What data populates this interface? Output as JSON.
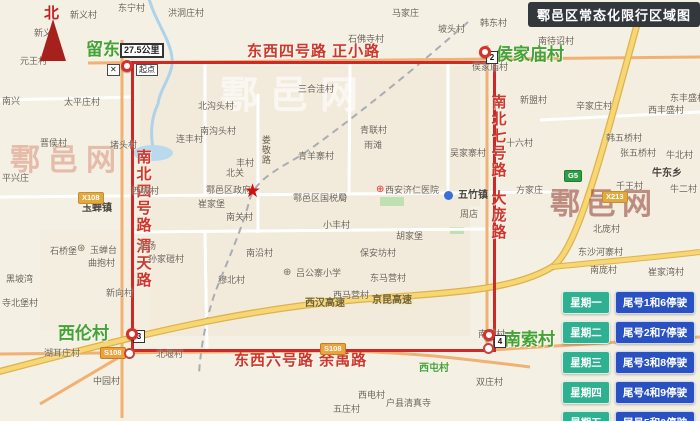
{
  "title": "鄠邑区常态化限行区域图",
  "compass_label": "北",
  "watermark_text": "鄠邑网",
  "colors": {
    "zone_border": "#cd2a27",
    "road_label_red": "#ce372c",
    "village_green": "#44a335",
    "legend_day_green": "#2fb090",
    "legend_rule_blue": "#2a51c2",
    "banner_bg": "#33383d"
  },
  "legend_rows": [
    {
      "day": "星期一",
      "rule": "尾号1和6停驶"
    },
    {
      "day": "星期二",
      "rule": "尾号2和7停驶"
    },
    {
      "day": "星期三",
      "rule": "尾号3和8停驶"
    },
    {
      "day": "星期四",
      "rule": "尾号4和9停驶"
    },
    {
      "day": "星期五",
      "rule": "尾号5和0停驶"
    }
  ],
  "map_labels": [
    {
      "t": "东西四号路  正小路",
      "x": 247,
      "y": 44,
      "c": "rh",
      "n": "top-boundary-road-label"
    },
    {
      "t": "东西六号路  余禹路",
      "x": 234,
      "y": 353,
      "c": "rh",
      "n": "bottom-boundary-road-label"
    },
    {
      "t": "南北四号路",
      "x": 134,
      "y": 149,
      "c": "rv",
      "n": "left-boundary-road-label"
    },
    {
      "t": "渭天路",
      "x": 134,
      "y": 238,
      "c": "rv",
      "n": "left-boundary-road-label-2"
    },
    {
      "t": "南北七号路",
      "x": 489,
      "y": 94,
      "c": "rv",
      "n": "right-boundary-road-label"
    },
    {
      "t": "大庞路",
      "x": 489,
      "y": 190,
      "c": "rv",
      "n": "right-boundary-road-label-2"
    },
    {
      "t": "留东",
      "x": 86,
      "y": 41,
      "c": "grl",
      "n": "village-label-liudong"
    },
    {
      "t": "侯家庙村",
      "x": 496,
      "y": 46,
      "c": "grl",
      "n": "village-label-houjiamiao"
    },
    {
      "t": "西伦村",
      "x": 58,
      "y": 325,
      "c": "grl",
      "n": "village-label-xilun"
    },
    {
      "t": "南索村",
      "x": 504,
      "y": 331,
      "c": "grl",
      "n": "village-label-nansuo"
    },
    {
      "t": "西屯村",
      "x": 419,
      "y": 363,
      "c": "grs"
    },
    {
      "t": "鄠邑网",
      "x": 220,
      "y": 76,
      "c": "wm1",
      "n": "watermark"
    },
    {
      "t": "鄠邑网",
      "x": 10,
      "y": 144,
      "c": "wm2",
      "n": "watermark"
    },
    {
      "t": "鄠邑网",
      "x": 550,
      "y": 188,
      "c": "wm3",
      "n": "watermark"
    },
    {
      "t": "西汉高速",
      "x": 305,
      "y": 298,
      "c": "hw",
      "n": "expressway-label"
    },
    {
      "t": "京昆高速",
      "x": 372,
      "y": 295,
      "c": "hw",
      "n": "expressway-label"
    },
    {
      "t": "娄敬路",
      "x": 260,
      "y": 135,
      "c": "pv"
    },
    {
      "t": "新义村",
      "x": 70,
      "y": 11,
      "c": "pl"
    },
    {
      "t": "东宁村",
      "x": 118,
      "y": 4,
      "c": "pl"
    },
    {
      "t": "新义",
      "x": 34,
      "y": 29,
      "c": "pl"
    },
    {
      "t": "元王村",
      "x": 20,
      "y": 57,
      "c": "pl"
    },
    {
      "t": "洪洞庄村",
      "x": 168,
      "y": 9,
      "c": "pl"
    },
    {
      "t": "马家庄",
      "x": 392,
      "y": 9,
      "c": "pl"
    },
    {
      "t": "坡头村",
      "x": 438,
      "y": 25,
      "c": "pl"
    },
    {
      "t": "韩东村",
      "x": 480,
      "y": 19,
      "c": "pl"
    },
    {
      "t": "石佛寺村",
      "x": 348,
      "y": 35,
      "c": "pl"
    },
    {
      "t": "南待诏村",
      "x": 538,
      "y": 37,
      "c": "pl"
    },
    {
      "t": "户县东立交",
      "x": 610,
      "y": 6,
      "c": "pl"
    },
    {
      "t": "东丰盛村",
      "x": 670,
      "y": 94,
      "c": "pl"
    },
    {
      "t": "西丰盛村",
      "x": 648,
      "y": 106,
      "c": "pl"
    },
    {
      "t": "辛家庄村",
      "x": 576,
      "y": 102,
      "c": "pl"
    },
    {
      "t": "韩五桥村",
      "x": 606,
      "y": 134,
      "c": "pl"
    },
    {
      "t": "张五桥村",
      "x": 620,
      "y": 149,
      "c": "pl"
    },
    {
      "t": "牛北村",
      "x": 666,
      "y": 151,
      "c": "pl"
    },
    {
      "t": "牛东乡",
      "x": 652,
      "y": 168,
      "c": "bd"
    },
    {
      "t": "千王村",
      "x": 616,
      "y": 182,
      "c": "pl"
    },
    {
      "t": "牛二村",
      "x": 670,
      "y": 185,
      "c": "pl"
    },
    {
      "t": "南兴",
      "x": 2,
      "y": 97,
      "c": "pl"
    },
    {
      "t": "太平庄村",
      "x": 64,
      "y": 98,
      "c": "pl"
    },
    {
      "t": "晋侯村",
      "x": 40,
      "y": 139,
      "c": "pl"
    },
    {
      "t": "平兴庄",
      "x": 2,
      "y": 174,
      "c": "pl"
    },
    {
      "t": "堵头村",
      "x": 110,
      "y": 141,
      "c": "pl"
    },
    {
      "t": "西坡村",
      "x": 132,
      "y": 187,
      "c": "pl"
    },
    {
      "t": "玉蝉镇",
      "x": 82,
      "y": 203,
      "c": "bd"
    },
    {
      "t": "北场",
      "x": 138,
      "y": 242,
      "c": "pl"
    },
    {
      "t": "孙家磑村",
      "x": 148,
      "y": 255,
      "c": "pl"
    },
    {
      "t": "石桥堡",
      "x": 50,
      "y": 247,
      "c": "pl"
    },
    {
      "t": "玉蝉台",
      "x": 90,
      "y": 246,
      "c": "pl"
    },
    {
      "t": "曲抱村",
      "x": 88,
      "y": 259,
      "c": "pl"
    },
    {
      "t": "黑坡湾",
      "x": 6,
      "y": 275,
      "c": "pl"
    },
    {
      "t": "寺北堡村",
      "x": 2,
      "y": 299,
      "c": "pl"
    },
    {
      "t": "新向村",
      "x": 106,
      "y": 289,
      "c": "pl"
    },
    {
      "t": "湖耳庄村",
      "x": 44,
      "y": 349,
      "c": "pl"
    },
    {
      "t": "中园村",
      "x": 93,
      "y": 377,
      "c": "pl"
    },
    {
      "t": "北堰村",
      "x": 156,
      "y": 350,
      "c": "pl"
    },
    {
      "t": "南关村",
      "x": 226,
      "y": 213,
      "c": "pl"
    },
    {
      "t": "崔家堡",
      "x": 198,
      "y": 200,
      "c": "pl"
    },
    {
      "t": "北关",
      "x": 226,
      "y": 169,
      "c": "pl"
    },
    {
      "t": "鄠邑区政府",
      "x": 206,
      "y": 186,
      "c": "pl",
      "n": "district-government-label"
    },
    {
      "t": "鄠邑区国税局",
      "x": 293,
      "y": 194,
      "c": "pl",
      "n": "tax-bureau-label"
    },
    {
      "t": "西安济仁医院",
      "x": 385,
      "y": 186,
      "c": "pl",
      "n": "hospital-label"
    },
    {
      "t": "五竹镇",
      "x": 458,
      "y": 190,
      "c": "bd"
    },
    {
      "t": "周店",
      "x": 460,
      "y": 210,
      "c": "pl"
    },
    {
      "t": "吴家寨村",
      "x": 450,
      "y": 149,
      "c": "pl"
    },
    {
      "t": "十六村",
      "x": 506,
      "y": 139,
      "c": "pl"
    },
    {
      "t": "新盟村",
      "x": 520,
      "y": 96,
      "c": "pl"
    },
    {
      "t": "方家庄",
      "x": 516,
      "y": 186,
      "c": "pl"
    },
    {
      "t": "青羊寨村",
      "x": 298,
      "y": 152,
      "c": "pl"
    },
    {
      "t": "青联村",
      "x": 360,
      "y": 126,
      "c": "pl"
    },
    {
      "t": "雨滩",
      "x": 364,
      "y": 141,
      "c": "pl"
    },
    {
      "t": "丰村",
      "x": 236,
      "y": 159,
      "c": "pl"
    },
    {
      "t": "三合洼村",
      "x": 298,
      "y": 85,
      "c": "pl"
    },
    {
      "t": "北沟头村",
      "x": 198,
      "y": 102,
      "c": "pl"
    },
    {
      "t": "南沟头村",
      "x": 200,
      "y": 127,
      "c": "pl"
    },
    {
      "t": "连丰村",
      "x": 176,
      "y": 135,
      "c": "pl"
    },
    {
      "t": "小丰村",
      "x": 323,
      "y": 221,
      "c": "pl"
    },
    {
      "t": "南沿村",
      "x": 246,
      "y": 249,
      "c": "pl"
    },
    {
      "t": "穆北村",
      "x": 218,
      "y": 276,
      "c": "pl"
    },
    {
      "t": "吕公寨小学",
      "x": 296,
      "y": 269,
      "c": "pl",
      "n": "school-label"
    },
    {
      "t": "东马营村",
      "x": 370,
      "y": 274,
      "c": "pl"
    },
    {
      "t": "西马营村",
      "x": 333,
      "y": 291,
      "c": "pl"
    },
    {
      "t": "胡家堡",
      "x": 396,
      "y": 232,
      "c": "pl"
    },
    {
      "t": "保安坊村",
      "x": 360,
      "y": 249,
      "c": "pl"
    },
    {
      "t": "北庞村",
      "x": 593,
      "y": 225,
      "c": "pl"
    },
    {
      "t": "东沙河寨村",
      "x": 578,
      "y": 248,
      "c": "pl"
    },
    {
      "t": "南庞村",
      "x": 590,
      "y": 266,
      "c": "pl"
    },
    {
      "t": "崔家湾村",
      "x": 648,
      "y": 268,
      "c": "pl"
    },
    {
      "t": "西电村",
      "x": 358,
      "y": 391,
      "c": "pl"
    },
    {
      "t": "双庄村",
      "x": 476,
      "y": 378,
      "c": "pl"
    },
    {
      "t": "五庄村",
      "x": 333,
      "y": 405,
      "c": "pl"
    },
    {
      "t": "户县清真寺",
      "x": 386,
      "y": 399,
      "c": "pl"
    },
    {
      "t": "侯家庙村",
      "x": 472,
      "y": 63,
      "c": "pl"
    },
    {
      "t": "南索村",
      "x": 478,
      "y": 330,
      "c": "pl"
    }
  ],
  "road_badges": [
    {
      "t": "X108",
      "x": 78,
      "y": 192,
      "k": "county"
    },
    {
      "t": "X213",
      "x": 602,
      "y": 191,
      "k": "county"
    },
    {
      "t": "S108",
      "x": 100,
      "y": 347,
      "k": "prov"
    },
    {
      "t": "S108",
      "x": 320,
      "y": 343,
      "k": "prov"
    },
    {
      "t": "G5",
      "x": 564,
      "y": 170,
      "k": "national"
    }
  ],
  "white_boxes": [
    {
      "t": "27.5公里",
      "x": 120,
      "y": 43,
      "big": true,
      "n": "distance-label"
    },
    {
      "t": "起点",
      "x": 136,
      "y": 64,
      "big": false,
      "n": "start-point-label"
    },
    {
      "t": "✕",
      "x": 107,
      "y": 64,
      "big": false,
      "n": "no-entry-icon"
    }
  ],
  "number_badges": [
    {
      "t": "2",
      "x": 486,
      "y": 51
    },
    {
      "t": "3",
      "x": 133,
      "y": 330
    },
    {
      "t": "4",
      "x": 494,
      "y": 335
    }
  ],
  "pins": [
    {
      "x": 121,
      "y": 60
    },
    {
      "x": 479,
      "y": 46
    },
    {
      "x": 126,
      "y": 328
    },
    {
      "x": 483,
      "y": 329
    }
  ],
  "rings": [
    {
      "x": 124,
      "y": 348
    },
    {
      "x": 483,
      "y": 343
    }
  ],
  "poi": [
    {
      "k": "star",
      "x": 244,
      "y": 182,
      "n": "government-star-icon"
    },
    {
      "k": "tax",
      "x": 339,
      "y": 193,
      "n": "tax-office-icon"
    },
    {
      "k": "hospital",
      "x": 376,
      "y": 185,
      "n": "hospital-cross-icon"
    },
    {
      "k": "school",
      "x": 283,
      "y": 268,
      "n": "school-icon"
    },
    {
      "k": "heritage",
      "x": 77,
      "y": 244,
      "n": "heritage-site-icon"
    },
    {
      "k": "bluedot",
      "x": 444,
      "y": 191,
      "n": "town-dot-icon"
    }
  ]
}
